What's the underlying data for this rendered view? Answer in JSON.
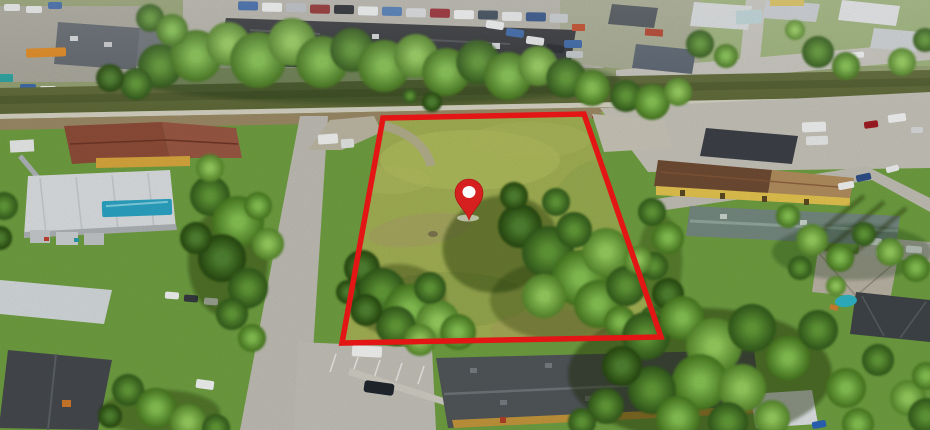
{
  "meta": {
    "title": "Aerial drone photo of vacant land parcel for sale",
    "image_type": "aerial-photograph",
    "description": "Bird's-eye view of a grassy vacant lot outlined with a red parcel boundary and marked with a red location pin. A railroad corridor and commercial parking lots run along the top, residential streets, houses, apartment buildings, pools and dense trees surround the lot."
  },
  "annotations": {
    "parcel_boundary": {
      "points": "383,118 584,114 661,337 342,343",
      "color": "#e31515",
      "stroke_width": 5.5
    },
    "pin": {
      "transform": "translate(469,197)",
      "color": "#d61f1f",
      "inner_color": "#ffffff"
    }
  },
  "scene": {
    "colors": {
      "lot_grass": "#a3b154",
      "surrounding_lawn": "#6f9f41",
      "road_asphalt": "#bfbdb4",
      "railroad_brush": "#5f6a38",
      "railroad_dirt": "#9c8a66",
      "commercial_roof": "#333539",
      "yellow_building_wall": "#e4c44f",
      "pool_water": "#2fb4c6",
      "blue_awning": "#2ba4c4"
    },
    "features": [
      "vacant-lot",
      "parcel-boundary",
      "location-pin",
      "railroad-corridor",
      "commercial-building",
      "parking-lot",
      "parked-cars",
      "residential-streets",
      "houses",
      "apartment-building",
      "swimming-pool",
      "palm-trees",
      "tree-clusters"
    ]
  }
}
